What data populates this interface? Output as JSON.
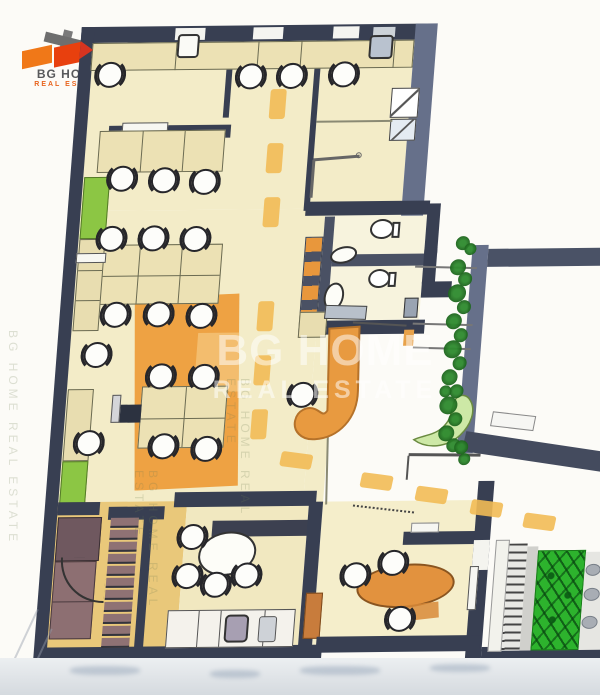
{
  "logo": {
    "line1": "BG HOME",
    "line2": "REAL ESTATE"
  },
  "watermark": {
    "line1": "BG HOME",
    "line2": "REAL ESTATE",
    "side_text": "BG HOME REAL ESTATE"
  },
  "colors": {
    "wall": "#383f52",
    "wall_exterior": "#66708a",
    "floor": "#f3ecc8",
    "floor_gold": "#e9c87a",
    "carpet": "#eea243",
    "carpet_light": "#f3bd6e",
    "desk": "#ece1b4",
    "cabinet_green": "#8cc644",
    "hedge_green": "#cde8a6",
    "garden_green": "#2db32d",
    "path_orange": "#f2bb55",
    "stair_wood": "#8f7274",
    "furniture_brown": "#8d6f72",
    "table_orange": "#e2923e",
    "door_wood": "#c87c3c",
    "accent_red": "#d63420"
  },
  "plan": {
    "chairs": [
      [
        116,
        76
      ],
      [
        257,
        79
      ],
      [
        298,
        79
      ],
      [
        350,
        78
      ],
      [
        136,
        180
      ],
      [
        178,
        182
      ],
      [
        219,
        184
      ],
      [
        130,
        240
      ],
      [
        172,
        240
      ],
      [
        214,
        241
      ],
      [
        140,
        316
      ],
      [
        183,
        316
      ],
      [
        226,
        318
      ],
      [
        124,
        356
      ],
      [
        123,
        444
      ],
      [
        190,
        378
      ],
      [
        233,
        379
      ],
      [
        198,
        448
      ],
      [
        241,
        451
      ],
      [
        333,
        398
      ],
      [
        400,
        579
      ],
      [
        437,
        567
      ],
      [
        448,
        623
      ],
      [
        234,
        539
      ],
      [
        232,
        578
      ],
      [
        261,
        587
      ],
      [
        291,
        578
      ]
    ],
    "dashes_vertical": [
      [
        278,
        92
      ],
      [
        279,
        146
      ],
      [
        280,
        200
      ],
      [
        282,
        304
      ],
      [
        283,
        358
      ],
      [
        284,
        412
      ]
    ],
    "dashes_horizontal": [
      [
        316,
        456
      ],
      [
        398,
        478
      ],
      [
        454,
        492
      ],
      [
        510,
        506
      ],
      [
        564,
        520
      ]
    ],
    "stair_treads": {
      "x": 151,
      "y": 519,
      "w": 28,
      "h": 10,
      "step": 12,
      "count": 11
    },
    "bushes": [
      [
        479,
        272,
        8
      ],
      [
        487,
        284,
        7
      ],
      [
        480,
        298,
        9
      ],
      [
        488,
        312,
        7
      ],
      [
        479,
        326,
        8
      ],
      [
        487,
        340,
        7
      ],
      [
        480,
        354,
        9
      ],
      [
        488,
        368,
        7
      ],
      [
        479,
        382,
        8
      ],
      [
        487,
        396,
        7
      ],
      [
        480,
        410,
        9
      ],
      [
        488,
        424,
        7
      ],
      [
        480,
        438,
        8
      ],
      [
        488,
        450,
        7
      ],
      [
        482,
        248,
        7
      ],
      [
        490,
        254,
        6
      ],
      [
        476,
        396,
        6
      ],
      [
        496,
        452,
        7
      ],
      [
        500,
        464,
        6
      ]
    ]
  }
}
